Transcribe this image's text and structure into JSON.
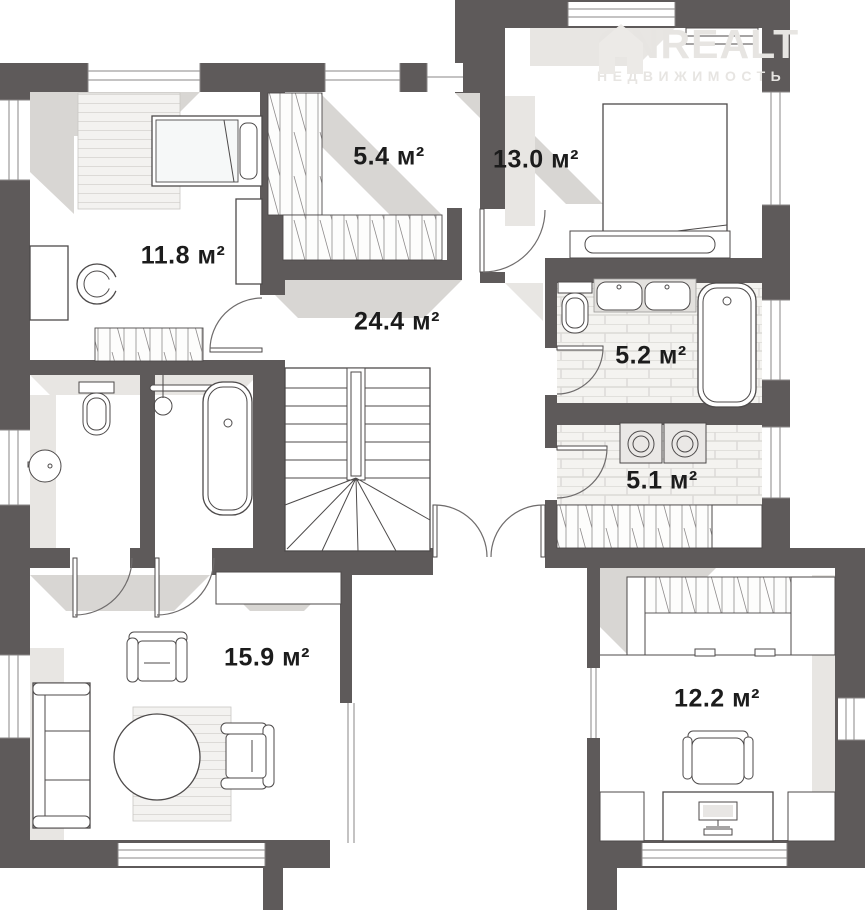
{
  "plan_title": "floor-plan",
  "watermark": {
    "brand": "ONREALT",
    "subtitle": "НЕДВИЖИМОСТЬ"
  },
  "rooms": [
    {
      "name": "bedroom-1",
      "area_label": "11.8 м²"
    },
    {
      "name": "closet",
      "area_label": "5.4 м²"
    },
    {
      "name": "bedroom-2",
      "area_label": "13.0 м²"
    },
    {
      "name": "hallway",
      "area_label": "24.4 м²"
    },
    {
      "name": "bathroom",
      "area_label": "5.2 м²"
    },
    {
      "name": "laundry",
      "area_label": "5.1 м²"
    },
    {
      "name": "living-room",
      "area_label": "15.9 м²"
    },
    {
      "name": "office",
      "area_label": "12.2 м²"
    }
  ],
  "colors": {
    "wall": "#5e5a5a",
    "shadow": "#d8d6d3",
    "shadow_light": "#e8e6e3",
    "line": "#4d4a4a",
    "text": "#1c1c1c",
    "watermark": "#e7e5e2",
    "brick_bg": "#f4f3f0",
    "brick_line": "#dbd9d6"
  }
}
